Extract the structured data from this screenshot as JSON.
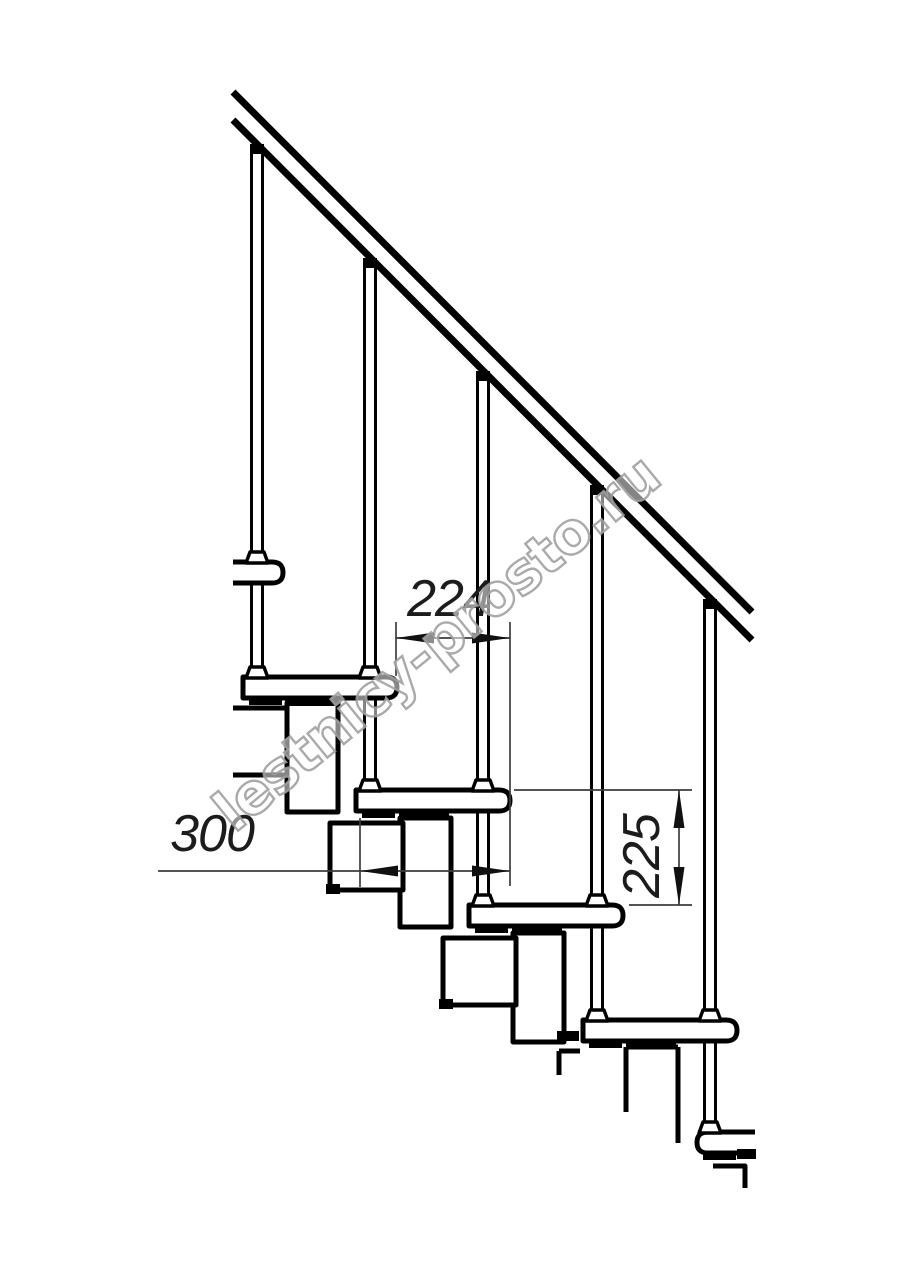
{
  "drawing": {
    "kind": "modular-staircase-side-elevation",
    "dimensions": {
      "step_run": {
        "label": "224",
        "orientation": "horizontal"
      },
      "tread_depth": {
        "label": "300",
        "orientation": "horizontal"
      },
      "step_rise": {
        "label": "225",
        "orientation": "vertical"
      }
    },
    "watermark": {
      "text": "lestnicy-prosto.ru"
    },
    "colors": {
      "background": "#ffffff",
      "linework": "#000000",
      "dimension_lines": "#3d3d3d",
      "dimension_text": "#1c1c1c",
      "watermark_outline": "#9e9e9e"
    }
  }
}
